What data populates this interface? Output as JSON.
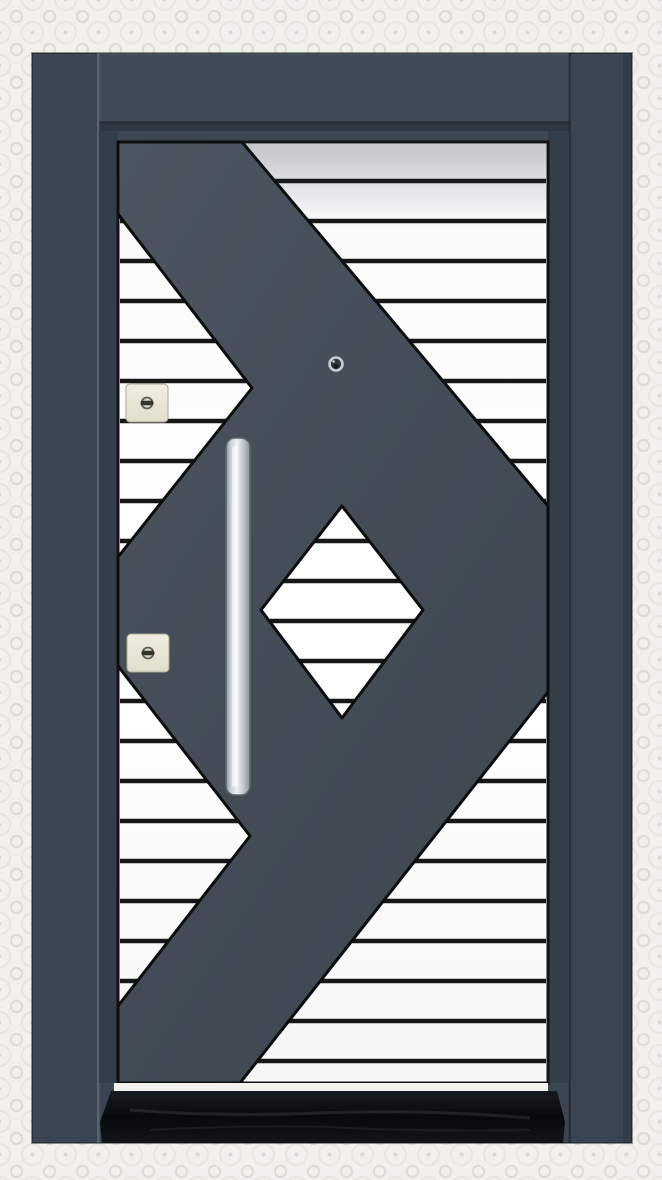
{
  "scene": {
    "subject": "Anthracite grey steel security door product photo: white horizontal-slat door panel overlaid with a dark geometric X pattern and central striped diamond window, long vertical stainless-steel pull handle, two ivory lock cylinders, metal peephole, black marble threshold, set in a light patterned wallpaper wall",
    "view": "front elevation"
  },
  "palette": {
    "wallpaper": "#f2f0ed",
    "wallpaper_motif": "#dfdcd6",
    "frame": "#3b4551",
    "frame_head": "#404b58",
    "frame_recess": "#2f3842",
    "leaf_stile": "#343e49",
    "top_rail": "#3d4753",
    "overlay_dark": "#46505a",
    "panel_white": "#ffffff",
    "stripe_line": "#171717",
    "panel_border": "#131313",
    "bottom_rail": "#f2f2ef",
    "threshold_black": "#0a0d12",
    "lock_body": "#ebe7d6",
    "lock_metal": "#60605a",
    "handle_silver": "#d9dcde",
    "peephole_ring": "#c8cdd3",
    "peephole_dark": "#31373f"
  },
  "door": {
    "stripes": {
      "x1": 120,
      "x2": 546,
      "y_start": 181,
      "y_end": 1061,
      "pitch": 40,
      "width": 4.5,
      "color": "@stripe_line"
    },
    "shapes": [
      {
        "tag": "rect",
        "name": "door-frame",
        "interactable": false,
        "attrs": {
          "x": 32,
          "y": 53,
          "width": 600,
          "height": 1090,
          "fill": "@frame",
          "stroke": "rgba(20,26,34,0.45)",
          "stroke-width": "2"
        }
      },
      {
        "tag": "rect",
        "name": "frame-head",
        "interactable": false,
        "attrs": {
          "x": 99,
          "y": 53,
          "width": 470,
          "height": 70,
          "fill": "@frame_head"
        }
      },
      {
        "tag": "rect",
        "name": "frame-head-shadow",
        "interactable": false,
        "attrs": {
          "x": 99,
          "y": 121,
          "width": 470,
          "height": 5,
          "fill": "rgba(0,0,0,0.33)"
        }
      },
      {
        "tag": "rect",
        "name": "frame-head-recess",
        "interactable": false,
        "attrs": {
          "x": 99,
          "y": 124,
          "width": 470,
          "height": 9,
          "fill": "@frame_recess"
        }
      },
      {
        "tag": "rect",
        "name": "left-jamb-seam",
        "interactable": false,
        "attrs": {
          "x": 97,
          "y": 53,
          "width": 2.5,
          "height": 1090,
          "fill": "rgba(255,255,255,0.16)"
        }
      },
      {
        "tag": "rect",
        "name": "right-jamb-seam",
        "interactable": false,
        "attrs": {
          "x": 568.5,
          "y": 53,
          "width": 2.5,
          "height": 1090,
          "fill": "rgba(0,0,0,0.30)"
        }
      },
      {
        "tag": "rect",
        "name": "right-jamb-outer-shade",
        "interactable": false,
        "attrs": {
          "x": 623,
          "y": 53,
          "width": 9,
          "height": 1090,
          "fill": "rgba(0,0,0,0.12)"
        }
      },
      {
        "tag": "rect",
        "name": "leaf-top-rail",
        "interactable": false,
        "attrs": {
          "x": 99,
          "y": 131,
          "width": 470,
          "height": 13,
          "fill": "@top_rail"
        }
      },
      {
        "tag": "rect",
        "name": "leaf-left-stile",
        "interactable": false,
        "attrs": {
          "x": 99,
          "y": 131,
          "width": 19,
          "height": 952,
          "fill": "@leaf_stile"
        }
      },
      {
        "tag": "rect",
        "name": "leaf-right-stile",
        "interactable": false,
        "attrs": {
          "x": 548,
          "y": 131,
          "width": 21,
          "height": 952,
          "fill": "@leaf_stile"
        }
      },
      {
        "tag": "rect",
        "name": "striped-panel",
        "interactable": false,
        "attrs": {
          "x": 118,
          "y": 142,
          "width": 430,
          "height": 941,
          "fill": "url(#gStripeBg)",
          "stroke": "@panel_border",
          "stroke-width": "3"
        }
      },
      {
        "tag": "stripes",
        "name": "stripe-line",
        "interactable": false
      },
      {
        "tag": "rect",
        "name": "panel-top-shade",
        "interactable": false,
        "attrs": {
          "x": 120,
          "y": 144,
          "width": 426,
          "height": 72,
          "fill": "url(#gTopShade)"
        }
      },
      {
        "tag": "path",
        "name": "geometric-x-overlay",
        "interactable": false,
        "attrs": {
          "d": "M118,142 L242,142 L548,506 L548,692 L240,1083 L118,1083 L118,1006 L250,836 L118,666 L118,557 L252,388 L118,214 Z M342,506 L423,610 L342,718 L261,610 Z",
          "fill": "url(#gDark)",
          "fill-rule": "evenodd",
          "stroke": "#0d0d0d",
          "stroke-width": "3",
          "stroke-linejoin": "round"
        }
      },
      {
        "tag": "rect",
        "name": "leaf-bottom-rail",
        "interactable": false,
        "attrs": {
          "x": 114,
          "y": 1083,
          "width": 434,
          "height": 8,
          "fill": "@bottom_rail"
        }
      },
      {
        "tag": "polygon",
        "name": "marble-threshold",
        "interactable": false,
        "attrs": {
          "points": "111,1091 557,1091 565,1122 563,1143 102,1143 100,1122",
          "fill": "url(#gThresh)"
        }
      },
      {
        "tag": "path",
        "name": "marble-vein",
        "interactable": false,
        "attrs": {
          "d": "M130,1110 q90,7 190,3 t210,5",
          "fill": "none",
          "stroke": "rgba(150,158,170,0.16)",
          "stroke-width": "3"
        }
      },
      {
        "tag": "path",
        "name": "marble-vein",
        "interactable": false,
        "attrs": {
          "d": "M150,1130 q120,-6 200,-2 t180,2",
          "fill": "none",
          "stroke": "rgba(150,158,170,0.10)",
          "stroke-width": "2"
        }
      },
      {
        "tag": "rect",
        "name": "pull-handle",
        "interactable": false,
        "attrs": {
          "x": 226,
          "y": 438,
          "width": 24,
          "height": 357,
          "rx": 9,
          "fill": "url(#gHandle)",
          "stroke": "#5f666c",
          "stroke-width": "1.5"
        }
      },
      {
        "tag": "rect",
        "name": "pull-handle-sheen",
        "interactable": false,
        "attrs": {
          "x": 232,
          "y": 446,
          "width": 6,
          "height": 341,
          "rx": 3,
          "fill": "rgba(255,255,255,0.55)"
        }
      },
      {
        "tag": "rect",
        "name": "upper-lock-plate",
        "interactable": false,
        "attrs": {
          "x": 126,
          "y": 384,
          "width": 42,
          "height": 38,
          "rx": 4,
          "fill": "url(#gLock)",
          "stroke": "#a9a695",
          "stroke-width": "1"
        }
      },
      {
        "tag": "circle",
        "name": "upper-lock-dial",
        "interactable": false,
        "attrs": {
          "cx": 147,
          "cy": 403,
          "r": 5.5,
          "fill": "#dbd7c5",
          "stroke": "@lock_metal",
          "stroke-width": "1.8"
        }
      },
      {
        "tag": "rect",
        "name": "upper-lock-slot",
        "interactable": false,
        "attrs": {
          "x": 140.5,
          "y": 400.8,
          "width": 13,
          "height": 4.4,
          "rx": 2.2,
          "fill": "#33332e"
        }
      },
      {
        "tag": "rect",
        "name": "lower-lock-plate",
        "interactable": false,
        "attrs": {
          "x": 127,
          "y": 634,
          "width": 42,
          "height": 38,
          "rx": 4,
          "fill": "url(#gLock)",
          "stroke": "#a9a695",
          "stroke-width": "1"
        }
      },
      {
        "tag": "circle",
        "name": "lower-lock-dial",
        "interactable": false,
        "attrs": {
          "cx": 148,
          "cy": 653,
          "r": 5.5,
          "fill": "#dbd7c5",
          "stroke": "@lock_metal",
          "stroke-width": "1.8"
        }
      },
      {
        "tag": "rect",
        "name": "lower-lock-slot",
        "interactable": false,
        "attrs": {
          "x": 141.5,
          "y": 650.8,
          "width": 13,
          "height": 4.4,
          "rx": 2.2,
          "fill": "#33332e"
        }
      },
      {
        "tag": "circle",
        "name": "peephole",
        "interactable": false,
        "attrs": {
          "cx": 336,
          "cy": 364,
          "r": 6.5,
          "fill": "@peephole_dark",
          "stroke": "@peephole_ring",
          "stroke-width": "2.6"
        }
      },
      {
        "tag": "circle",
        "name": "peephole-lens",
        "interactable": false,
        "attrs": {
          "cx": 336,
          "cy": 366.5,
          "r": 2.4,
          "fill": "#15181d"
        }
      },
      {
        "tag": "circle",
        "name": "peephole-glint",
        "interactable": false,
        "attrs": {
          "cx": 333.5,
          "cy": 361.5,
          "r": 1.2,
          "fill": "rgba(255,255,255,0.85)"
        }
      }
    ]
  }
}
